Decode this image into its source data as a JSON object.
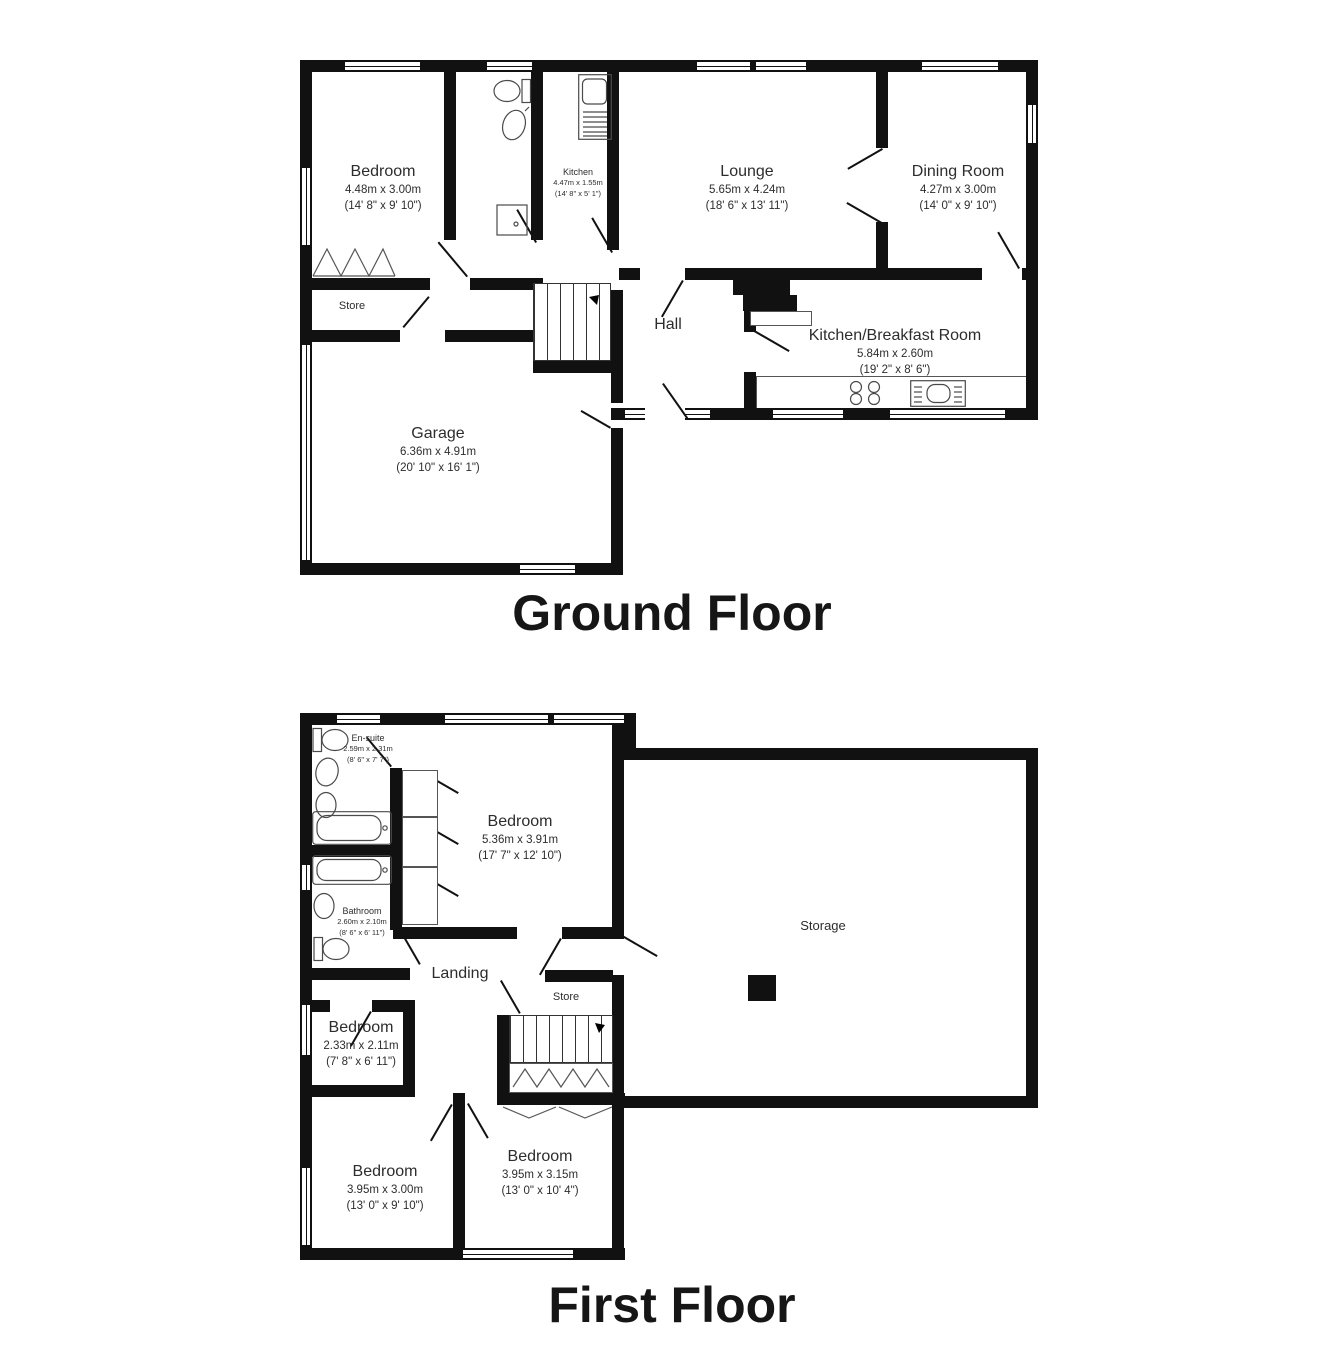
{
  "ground_floor": {
    "title": "Ground Floor",
    "rooms": {
      "bedroom": {
        "name": "Bedroom",
        "dims_m": "4.48m x 3.00m",
        "dims_ft": "(14' 8\" x 9' 10\")"
      },
      "kitchen": {
        "name": "Kitchen",
        "dims_m": "4.47m x 1.55m",
        "dims_ft": "(14' 8\" x 5' 1\")"
      },
      "lounge": {
        "name": "Lounge",
        "dims_m": "5.65m x 4.24m",
        "dims_ft": "(18' 6\" x 13' 11\")"
      },
      "dining_room": {
        "name": "Dining Room",
        "dims_m": "4.27m x 3.00m",
        "dims_ft": "(14' 0\" x 9' 10\")"
      },
      "store": {
        "name": "Store"
      },
      "hall": {
        "name": "Hall"
      },
      "kitchen_breakfast": {
        "name": "Kitchen/Breakfast Room",
        "dims_m": "5.84m x 2.60m",
        "dims_ft": "(19' 2\" x 8' 6\")"
      },
      "garage": {
        "name": "Garage",
        "dims_m": "6.36m x 4.91m",
        "dims_ft": "(20' 10\" x 16' 1\")"
      }
    }
  },
  "first_floor": {
    "title": "First Floor",
    "rooms": {
      "en_suite": {
        "name": "En-suite",
        "dims_m": "2.59m x 2.31m",
        "dims_ft": "(8' 6\" x 7' 7\")"
      },
      "bedroom_master": {
        "name": "Bedroom",
        "dims_m": "5.36m x 3.91m",
        "dims_ft": "(17' 7\" x 12' 10\")"
      },
      "bathroom": {
        "name": "Bathroom",
        "dims_m": "2.60m x 2.10m",
        "dims_ft": "(8' 6\" x 6' 11\")"
      },
      "storage": {
        "name": "Storage"
      },
      "landing": {
        "name": "Landing"
      },
      "store": {
        "name": "Store"
      },
      "bedroom_small": {
        "name": "Bedroom",
        "dims_m": "2.33m x 2.11m",
        "dims_ft": "(7' 8\" x 6' 11\")"
      },
      "bedroom_left": {
        "name": "Bedroom",
        "dims_m": "3.95m x 3.00m",
        "dims_ft": "(13' 0\" x 9' 10\")"
      },
      "bedroom_middle": {
        "name": "Bedroom",
        "dims_m": "3.95m x 3.15m",
        "dims_ft": "(13' 0\" x 10' 4\")"
      }
    }
  },
  "colors": {
    "wall": "#111111",
    "text": "#2d2d2d",
    "background": "#ffffff"
  }
}
